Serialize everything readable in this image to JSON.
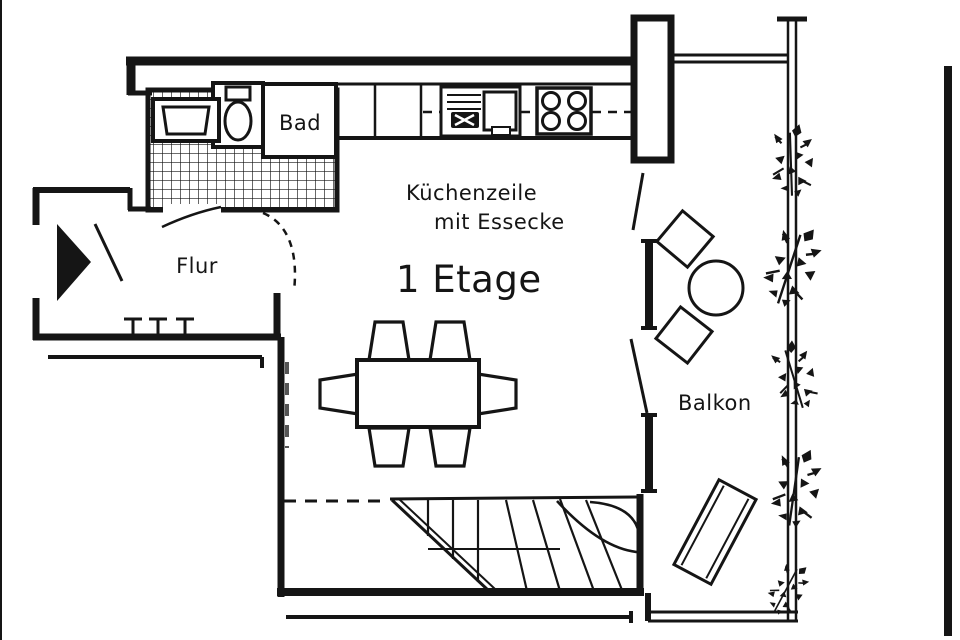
{
  "colors": {
    "ink": "#151515",
    "paper": "#ffffff"
  },
  "floorplan": {
    "floor_title": "1 Etage",
    "labels": {
      "bad": "Bad",
      "flur": "Flur",
      "kitchen_line1": "Küchenzeile",
      "kitchen_line2": "mit Essecke",
      "floor": "1 Etage",
      "balkon": "Balkon"
    },
    "rooms": [
      {
        "name": "bathroom",
        "label": "Bad"
      },
      {
        "name": "hallway",
        "label": "Flur"
      },
      {
        "name": "kitchen-living",
        "label": "Küchenzeile mit Essecke"
      },
      {
        "name": "balcony",
        "label": "Balkon"
      }
    ],
    "fixtures": [
      "bath-sink",
      "toilet",
      "tiled-floor",
      "kitchen-counter",
      "kitchen-sink",
      "stove-4-burner",
      "entrance-arrow",
      "entrance-door-swing",
      "coat-hooks-x3",
      "hall-door-swing",
      "dining-table",
      "dining-chairs-x6",
      "winder-staircase",
      "balcony-chairs-x2",
      "balcony-round-table",
      "sun-lounger",
      "balcony-railing",
      "plants-x5"
    ]
  }
}
